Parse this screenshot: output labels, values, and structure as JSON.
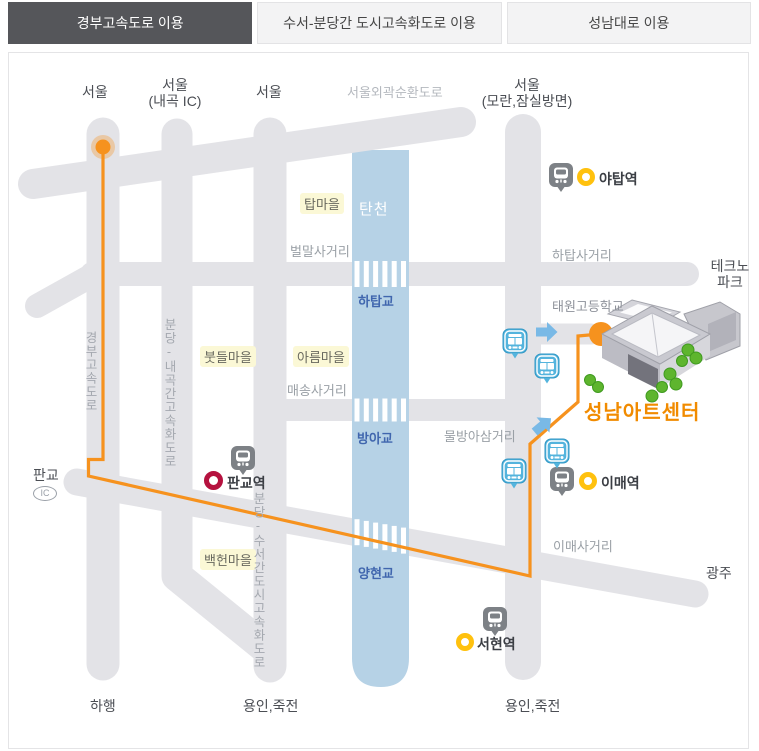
{
  "tabs": [
    {
      "label": "경부고속도로 이용",
      "active": true
    },
    {
      "label": "수서-분당간 도시고속화도로 이용",
      "active": false
    },
    {
      "label": "성남대로 이용",
      "active": false
    }
  ],
  "map": {
    "top_destinations": {
      "seoul_left": "서울",
      "seoul_naegok_line1": "서울",
      "seoul_naegok_line2": "(내곡 IC)",
      "seoul_mid": "서울",
      "ring_road": "서울외곽순환도로",
      "seoul_moran_line1": "서울",
      "seoul_moran_line2": "(모란,잠실방면)"
    },
    "edges": {
      "technopark_line1": "테크노",
      "technopark_line2": "파크",
      "gwangju": "광주",
      "pangyo": "판교",
      "pangyo_ic": "IC",
      "haheng": "하행",
      "yongin_left": "용인,죽전",
      "yongin_right": "용인,죽전"
    },
    "river": {
      "name": "탄천",
      "bridges": [
        "하탑교",
        "방아교",
        "양현교"
      ]
    },
    "crossings": [
      "벌말사거리",
      "하탑사거리",
      "매송사거리",
      "물방아삼거리",
      "이매사거리"
    ],
    "villages": [
      "탑마을",
      "붓들마을",
      "아름마을",
      "백헌마을"
    ],
    "highways": {
      "gyeongbu": "경부고속도로",
      "bundang_naegok": "분당-내곡간고속화도로",
      "bundang_suseo": "분당-수서간도시고속화도로"
    },
    "school": "태원고등학교",
    "stations": [
      {
        "name": "야탑역"
      },
      {
        "name": "판교역"
      },
      {
        "name": "이매역"
      },
      {
        "name": "서현역"
      }
    ],
    "destination": {
      "name": "성남아트센터"
    }
  },
  "colors": {
    "route_orange": "#f6921e",
    "road_gray": "#e3e3e7",
    "river_blue": "#b6d2e6",
    "station_ring_yellow": "#ffc10e",
    "pangyo_ring_red": "#b5123f",
    "bus_icon_blue": "#54b4dd",
    "subway_icon_gray": "#7d8186",
    "destination_text": "#f18b00",
    "bridge_text": "#4066ae",
    "active_tab_bg": "#55565a"
  }
}
